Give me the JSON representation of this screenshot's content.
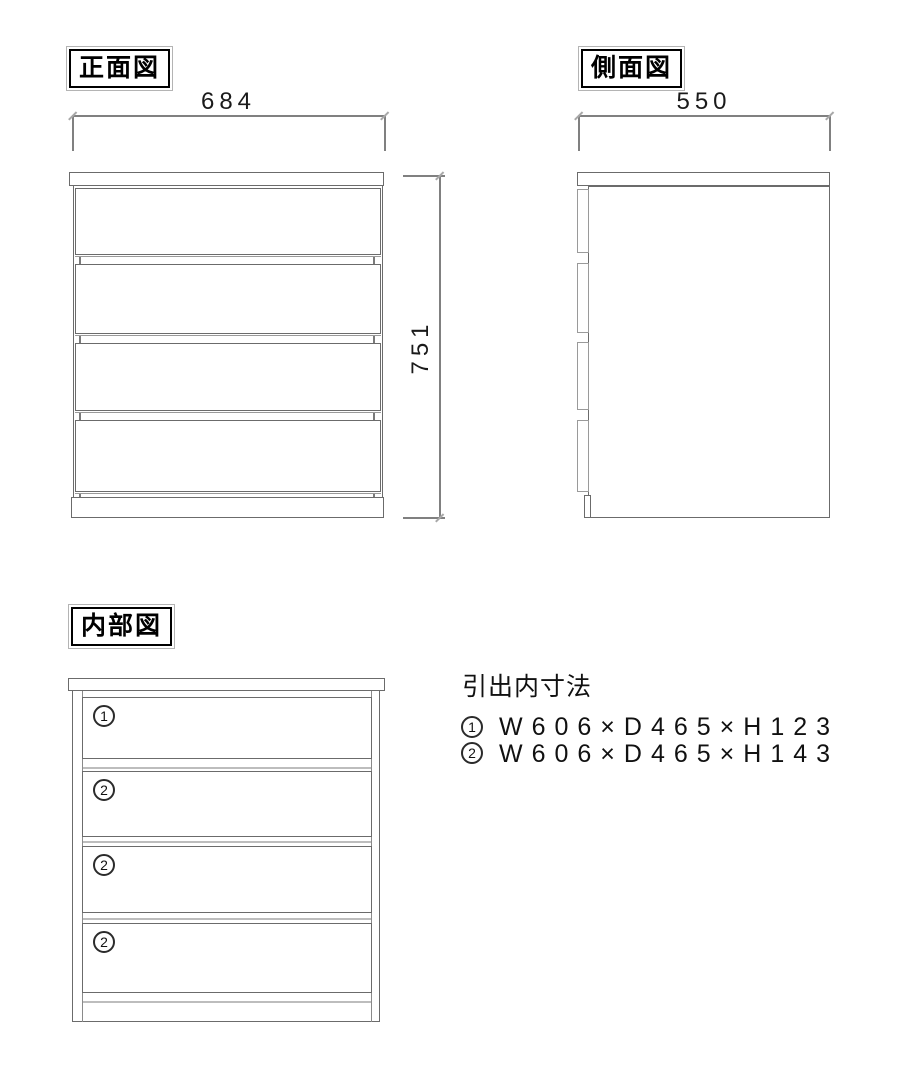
{
  "drawing": {
    "background": "#ffffff",
    "outline_color": "#6b6b6b",
    "light_line_color": "#9a9a9a",
    "dimension_line_color": "#808080",
    "text_color": "#1a1a1a"
  },
  "front_view": {
    "label": "正面図",
    "width_dim": "684",
    "height_dim": "751",
    "drawer_count": 4
  },
  "side_view": {
    "label": "側面図",
    "depth_dim": "550",
    "drawer_count": 4
  },
  "internal_view": {
    "label": "内部図",
    "drawer_labels": [
      "1",
      "2",
      "2",
      "2"
    ]
  },
  "legend": {
    "title": "引出内寸法",
    "items": [
      {
        "num": "1",
        "dims": "W606×D465×H123"
      },
      {
        "num": "2",
        "dims": "W606×D465×H143"
      }
    ]
  }
}
